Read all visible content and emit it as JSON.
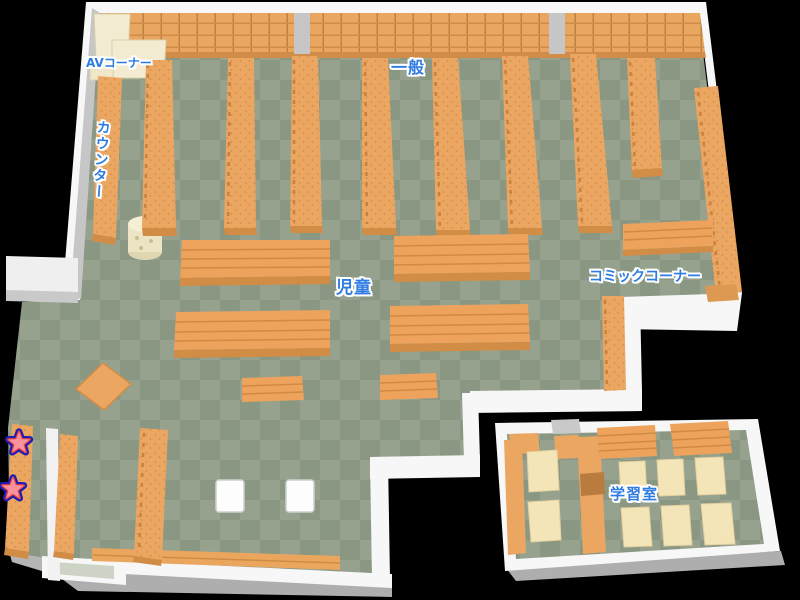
{
  "areas": {
    "av_corner": {
      "label": "AVコーナー"
    },
    "counter": {
      "label": "カウンター"
    },
    "general": {
      "label": "一般"
    },
    "children": {
      "label": "児童"
    },
    "comic_corner": {
      "label": "コミックコーナー"
    },
    "study_room": {
      "label": "学習室"
    }
  },
  "markers": {
    "type": "star",
    "count": 2,
    "fill": "#f9929b",
    "inner_outline": "#e8413c",
    "outer_outline": "#1c1cb8"
  },
  "palette": {
    "background": "#000000",
    "floor_light": "#96a28e",
    "floor_dark": "#8a9782",
    "shelf_orange": "#eba662",
    "shelf_ridge": "#cf8a44",
    "shelf_side": "#d18c46",
    "table_cream": "#f4e5b8",
    "av_cream": "#f3ecd2",
    "wall_white": "#f7f7f7",
    "wall_gray": "#c6c6c6",
    "label_blue": "#2e7ce2"
  }
}
